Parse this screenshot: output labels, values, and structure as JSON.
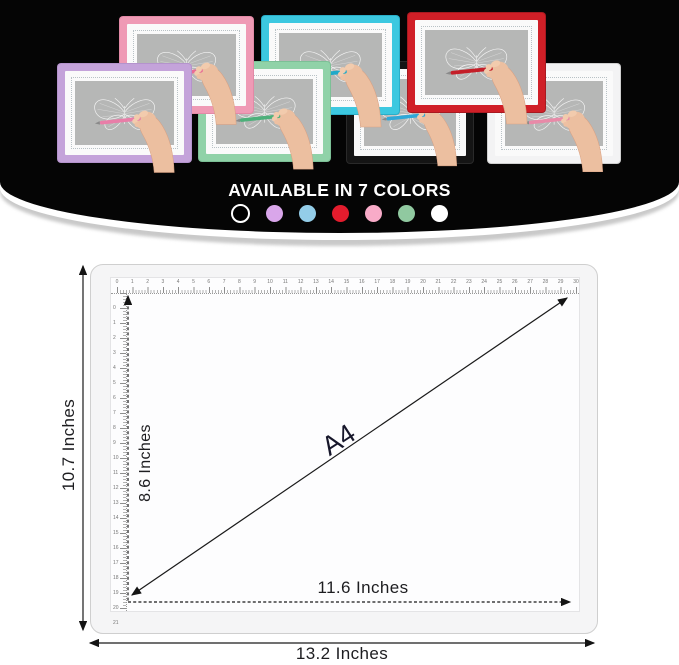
{
  "hero": {
    "title": "AVAILABLE IN 7 COLORS",
    "swatches": [
      {
        "name": "black",
        "hex": "#000000",
        "ring": "#ffffff"
      },
      {
        "name": "purple",
        "hex": "#d9a6ea"
      },
      {
        "name": "blue",
        "hex": "#93cde8"
      },
      {
        "name": "red",
        "hex": "#e31c2d"
      },
      {
        "name": "pink",
        "hex": "#f8abc8"
      },
      {
        "name": "green",
        "hex": "#90c9a0"
      },
      {
        "name": "white",
        "hex": "#ffffff"
      }
    ],
    "pads": [
      {
        "name": "black",
        "frame": "#151515",
        "stylus": "#2fa8d8",
        "edge": "#2a2a2a",
        "x": 347,
        "y": 62,
        "w": 126,
        "h": 101,
        "z": 1
      },
      {
        "name": "white",
        "frame": "#f3f3f4",
        "stylus": "#e88aa8",
        "edge": "#cfcfcf",
        "x": 488,
        "y": 64,
        "w": 132,
        "h": 99,
        "z": 2
      },
      {
        "name": "red",
        "frame": "#d01f27",
        "stylus": "#c41f29",
        "edge": "#a81920",
        "x": 408,
        "y": 13,
        "w": 137,
        "h": 99,
        "z": 3
      },
      {
        "name": "cyan",
        "frame": "#3cc8e0",
        "stylus": "#1fa9c9",
        "edge": "#2aaec8",
        "x": 262,
        "y": 16,
        "w": 137,
        "h": 98,
        "z": 4
      },
      {
        "name": "mint",
        "frame": "#90d2a8",
        "stylus": "#4db07a",
        "edge": "#7cc096",
        "x": 199,
        "y": 62,
        "w": 131,
        "h": 99,
        "z": 5
      },
      {
        "name": "pink",
        "frame": "#ef9ab5",
        "stylus": "#e86c96",
        "edge": "#e289a6",
        "x": 120,
        "y": 17,
        "w": 133,
        "h": 96,
        "z": 6
      },
      {
        "name": "purple",
        "frame": "#c4a3da",
        "stylus": "#e87ea8",
        "edge": "#b493cc",
        "x": 58,
        "y": 64,
        "w": 133,
        "h": 98,
        "z": 7
      }
    ]
  },
  "diagram": {
    "pad_label": "A4",
    "outer_height": "10.7 Inches",
    "inner_height": "8.6 Inches",
    "inner_width": "11.6 Inches",
    "outer_width": "13.2 Inches",
    "ruler_top": {
      "start": 0,
      "end": 30
    },
    "ruler_left": {
      "start": 0,
      "end": 21
    }
  }
}
